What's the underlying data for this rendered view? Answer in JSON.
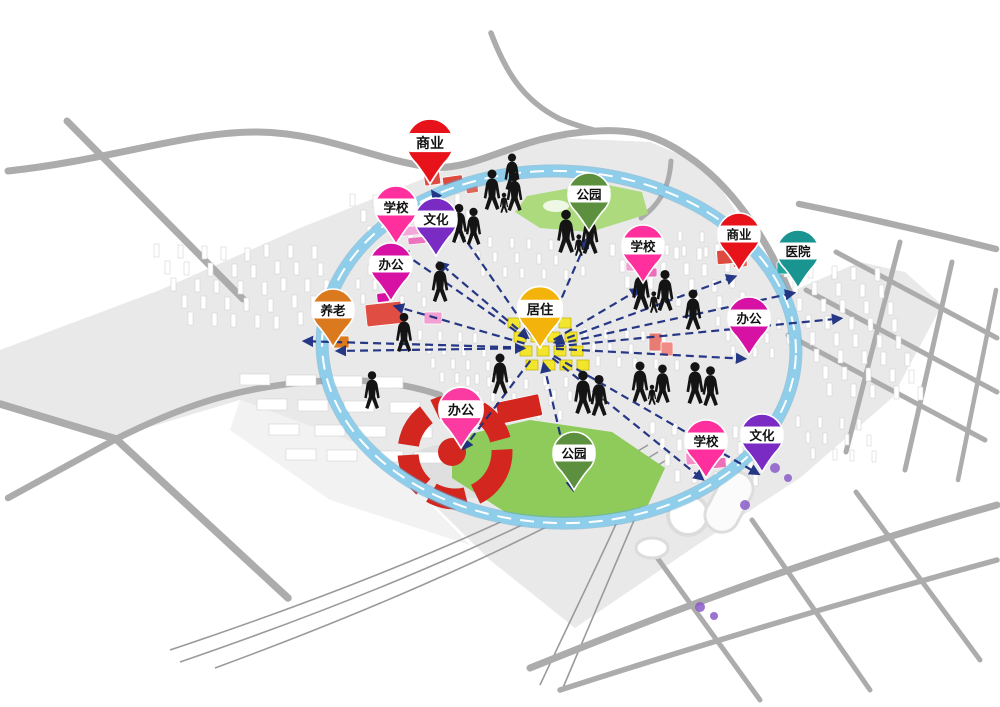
{
  "diagram": {
    "type": "urban-planning-concept-map",
    "hub_id": "juzhu",
    "pins": [
      {
        "id": "shangye-1",
        "label": "商业",
        "type": "commercial",
        "color": "#E8121B",
        "x": 430,
        "y": 184,
        "scale": 1.12
      },
      {
        "id": "xuexiao-1",
        "label": "学校",
        "type": "school",
        "color": "#FF2F9D",
        "x": 396,
        "y": 244,
        "scale": 1
      },
      {
        "id": "wenhua-1",
        "label": "文化",
        "type": "culture",
        "color": "#7A2BC3",
        "x": 436,
        "y": 256,
        "scale": 1
      },
      {
        "id": "bangong-1",
        "label": "办公",
        "type": "office",
        "color": "#D611A3",
        "x": 391,
        "y": 301,
        "scale": 1
      },
      {
        "id": "yanglao-1",
        "label": "养老",
        "type": "elderly-care",
        "color": "#DB791E",
        "x": 333,
        "y": 347,
        "scale": 1
      },
      {
        "id": "gongyuan-1",
        "label": "公园",
        "type": "park",
        "color": "#5C8F3E",
        "x": 589,
        "y": 231,
        "scale": 1
      },
      {
        "id": "xuexiao-2",
        "label": "学校",
        "type": "school",
        "color": "#FF2F9D",
        "x": 643,
        "y": 283,
        "scale": 1
      },
      {
        "id": "shangye-2",
        "label": "商业",
        "type": "commercial",
        "color": "#E8121B",
        "x": 739,
        "y": 271,
        "scale": 1
      },
      {
        "id": "yiyuan-1",
        "label": "医院",
        "type": "hospital",
        "color": "#1A9490",
        "x": 798,
        "y": 288,
        "scale": 1
      },
      {
        "id": "juzhu",
        "label": "居住",
        "type": "residential",
        "color": "#F3B30B",
        "x": 540,
        "y": 348,
        "scale": 1.06
      },
      {
        "id": "bangong-2",
        "label": "办公",
        "type": "office",
        "color": "#D611A3",
        "x": 749,
        "y": 355,
        "scale": 1
      },
      {
        "id": "bangong-3",
        "label": "办公",
        "type": "office",
        "color": "#FB3BA2",
        "x": 461,
        "y": 448,
        "scale": 1.05
      },
      {
        "id": "gongyuan-2",
        "label": "公园",
        "type": "park",
        "color": "#5C8F3E",
        "x": 574,
        "y": 490,
        "scale": 1
      },
      {
        "id": "xuexiao-3",
        "label": "学校",
        "type": "school",
        "color": "#FF2F9D",
        "x": 706,
        "y": 478,
        "scale": 1
      },
      {
        "id": "wenhua-2",
        "label": "文化",
        "type": "culture",
        "color": "#7A2BC3",
        "x": 762,
        "y": 472,
        "scale": 1
      }
    ],
    "connections": {
      "from": "juzhu",
      "to": [
        "shangye-1",
        "xuexiao-1",
        "wenhua-1",
        "bangong-1",
        "yanglao-1",
        "gongyuan-1",
        "xuexiao-2",
        "shangye-2",
        "yiyuan-1",
        "bangong-2",
        "bangong-3",
        "gongyuan-2",
        "xuexiao-3",
        "wenhua-2"
      ],
      "double_arrow": [
        "yanglao-1",
        "gongyuan-1",
        "shangye-2",
        "gongyuan-2",
        "wenhua-1"
      ],
      "extra_arrow_targets": [
        {
          "x": 300,
          "y": 341
        },
        {
          "x": 845,
          "y": 318
        }
      ]
    },
    "palette": {
      "loop_ribbon": "#8FCEEB",
      "loop_ribbon_edge": "#5AABD6",
      "loop_dash": "#FFFFFF",
      "flow_line": "#1C2E80",
      "road": "#ACACAC",
      "ground": "#E9E9E9",
      "building": "#FFFFFF",
      "park_light": "#ACDA7D",
      "park": "#8FCB5A",
      "landmark_red": "#D2261E",
      "residential_yellow": "#F2E52E",
      "figure": "#141414"
    }
  }
}
